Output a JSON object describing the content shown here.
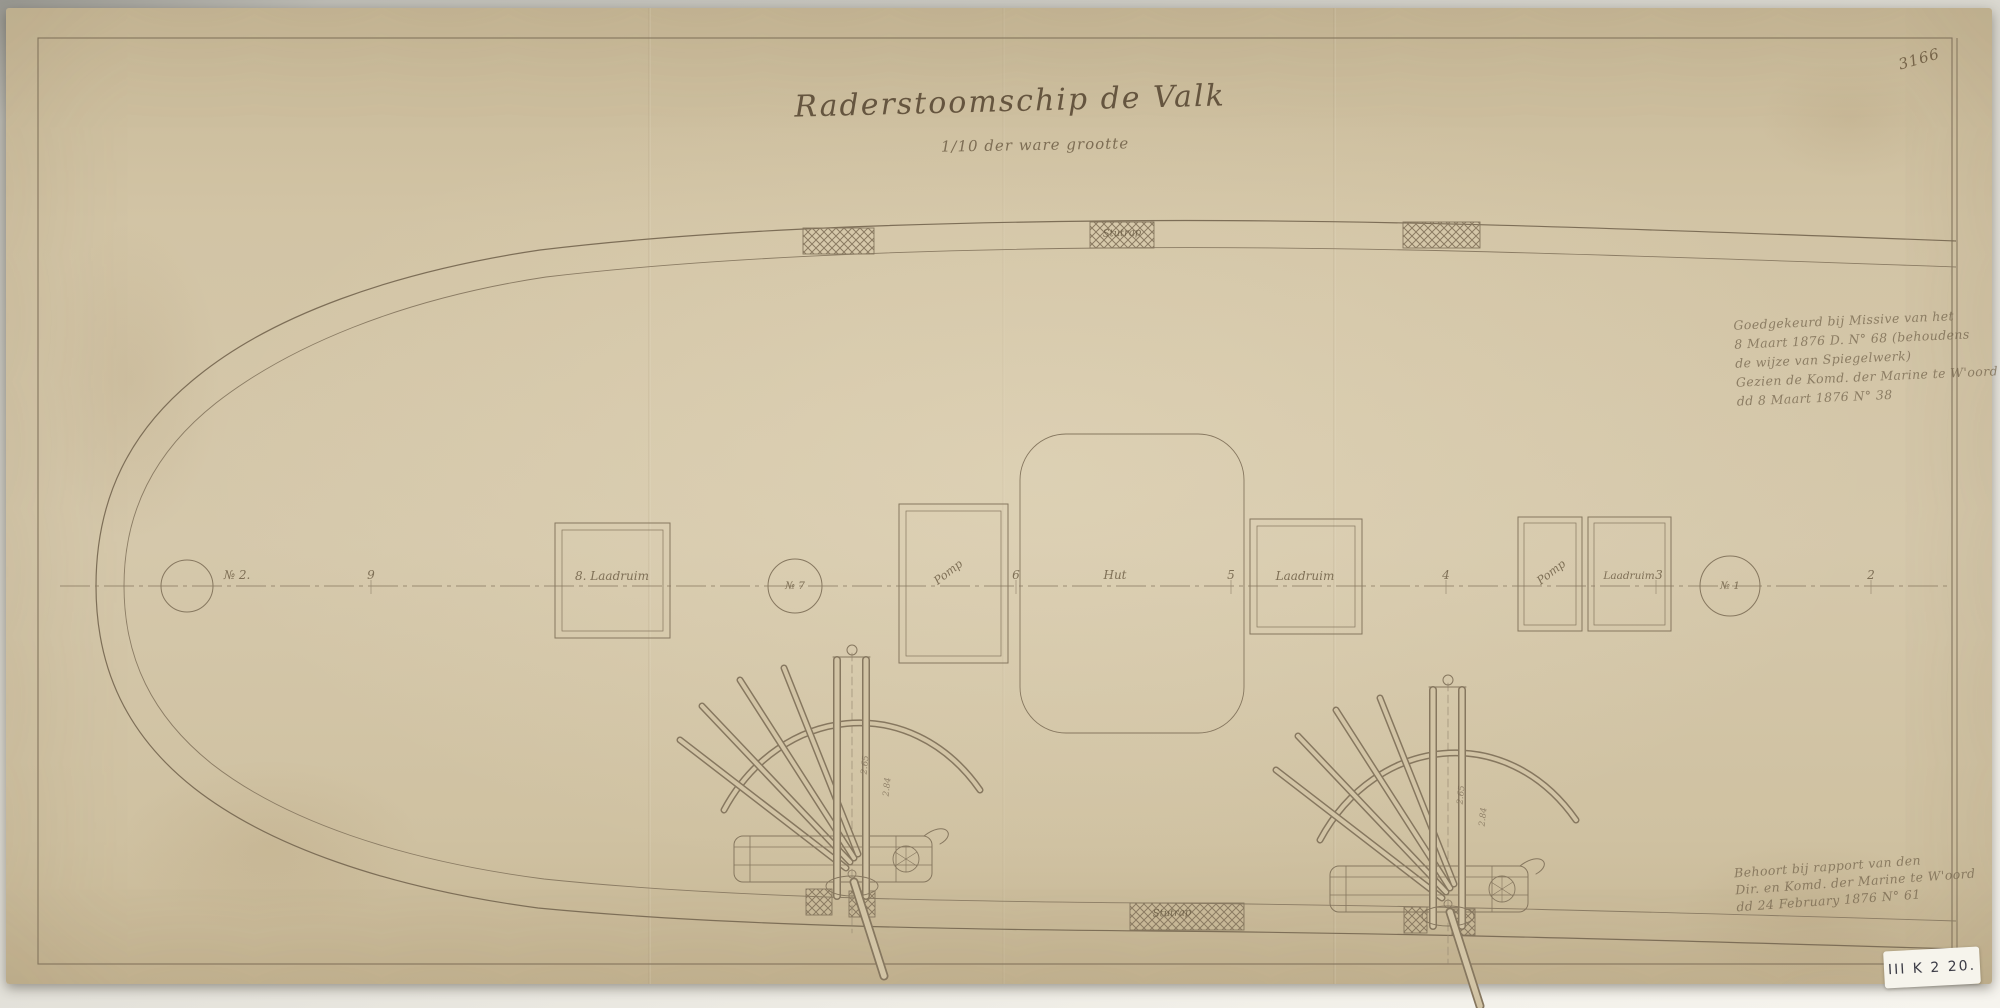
{
  "sheet": {
    "archive_label": "III K 2 20.",
    "corner_number": "3166"
  },
  "title": {
    "main": "Raderstoomschip de Valk",
    "subtitle": "1/10 der ware grootte"
  },
  "approval_note": {
    "line1": "Goedgekeurd bij Missive van het",
    "line2": "8 Maart 1876  D. N° 68  (behoudens",
    "line3": "de wijze van Spiegelwerk)",
    "line4": "Gezien de Komd. der Marine te W'oord",
    "line5": "dd 8 Maart 1876  N° 38"
  },
  "report_note": {
    "line1": "Behoort bij rapport van den",
    "line2": "Dir. en Komd. der Marine te W'oord",
    "line3": "dd 24 February 1876  N° 61"
  },
  "centerline_labels": {
    "l0": "№ 2.",
    "l1": "9",
    "l2": "8. Laadruim",
    "l3": "№ 7",
    "l4": "Pomp",
    "l5": "6",
    "l6": "Hut",
    "l7": "5",
    "l8": "Laadruim",
    "l9": "4",
    "l10": "Pomp",
    "l11": "Laadruim",
    "l12": "3",
    "l13": "№ 1",
    "l14": "2"
  },
  "bulwark_labels": {
    "top_gangway": "Stutrap",
    "bottom_gangway": "Stutrap"
  },
  "davit_dimensions": {
    "d1": "2.65",
    "d2": "2.84"
  },
  "colors": {
    "paper": "#d2c4a5",
    "ink": "#86775f",
    "pencil": "#9a8c74",
    "backdrop": "#e6e4dd",
    "label_bg": "#f6f4ec"
  }
}
